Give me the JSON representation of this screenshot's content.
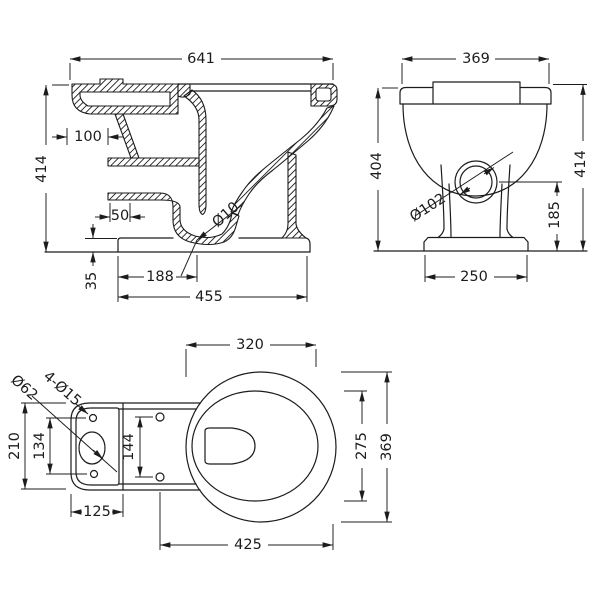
{
  "meta": {
    "drawing_type": "Technical dimension drawing",
    "subject": "Toilet pan - side section, front elevation and plan view",
    "units": "mm",
    "line_color": "#1c1c1c",
    "background_color": "#ffffff"
  },
  "side_view": {
    "overall_width": "641",
    "overall_height": "414",
    "rim_back_depth": "100",
    "channel_width": "50",
    "trap_bore": "Ø10",
    "plinth_height": "35",
    "outlet_setout": "188",
    "base_length": "455"
  },
  "front_view": {
    "rim_width": "369",
    "height_to_rim": "404",
    "overall_height": "414",
    "outlet_diameter": "Ø102",
    "outlet_centre_height": "185",
    "base_width": "250"
  },
  "plan_view": {
    "rim_front_width": "320",
    "bowl_outer_depth": "369",
    "bowl_inner_depth": "275",
    "overall_length": "425",
    "cistern_pad_width": "125",
    "cistern_pad_depth": "210",
    "pad_hole_spacing": "134",
    "seat_hole_spacing": "144",
    "inlet_oval_diameter": "Ø62",
    "fixing_holes": "4-Ø15"
  }
}
